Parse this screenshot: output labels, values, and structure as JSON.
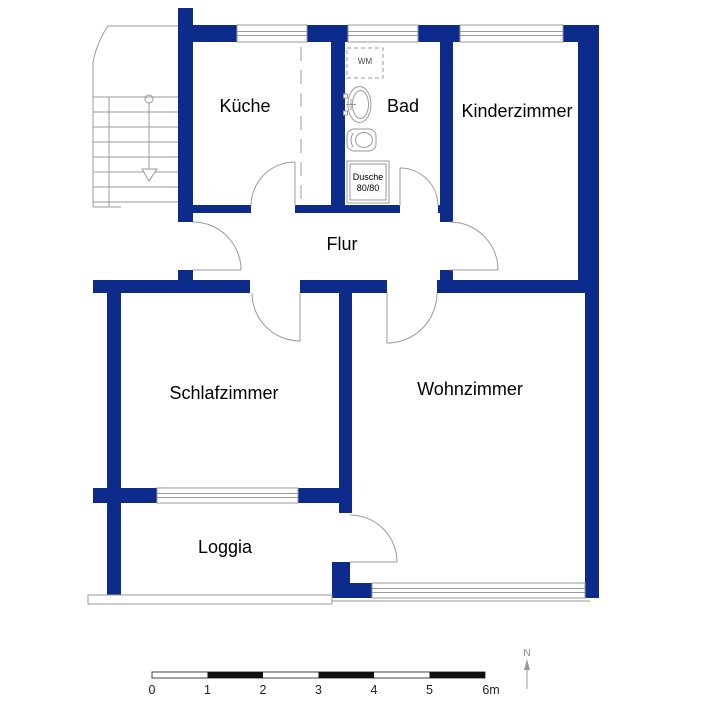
{
  "floorplan": {
    "rooms": [
      {
        "name": "kueche",
        "label": "Küche"
      },
      {
        "name": "bad",
        "label": "Bad"
      },
      {
        "name": "kinderzimmer",
        "label": "Kinderzimmer"
      },
      {
        "name": "flur",
        "label": "Flur"
      },
      {
        "name": "schlafzimmer",
        "label": "Schlafzimmer"
      },
      {
        "name": "wohnzimmer",
        "label": "Wohnzimmer"
      },
      {
        "name": "loggia",
        "label": "Loggia"
      }
    ],
    "bathroom_fixtures": {
      "washing_machine_label": "WM",
      "shower_label_line1": "Dusche",
      "shower_label_line2": "80/80"
    },
    "scale_bar": {
      "ticks": [
        "0",
        "1",
        "2",
        "3",
        "4",
        "5",
        "6m"
      ]
    },
    "compass": {
      "north_label": "N"
    },
    "colors": {
      "wall": "#0d2b8a",
      "drawing_line": "#999999",
      "label_text": "#000000"
    }
  }
}
